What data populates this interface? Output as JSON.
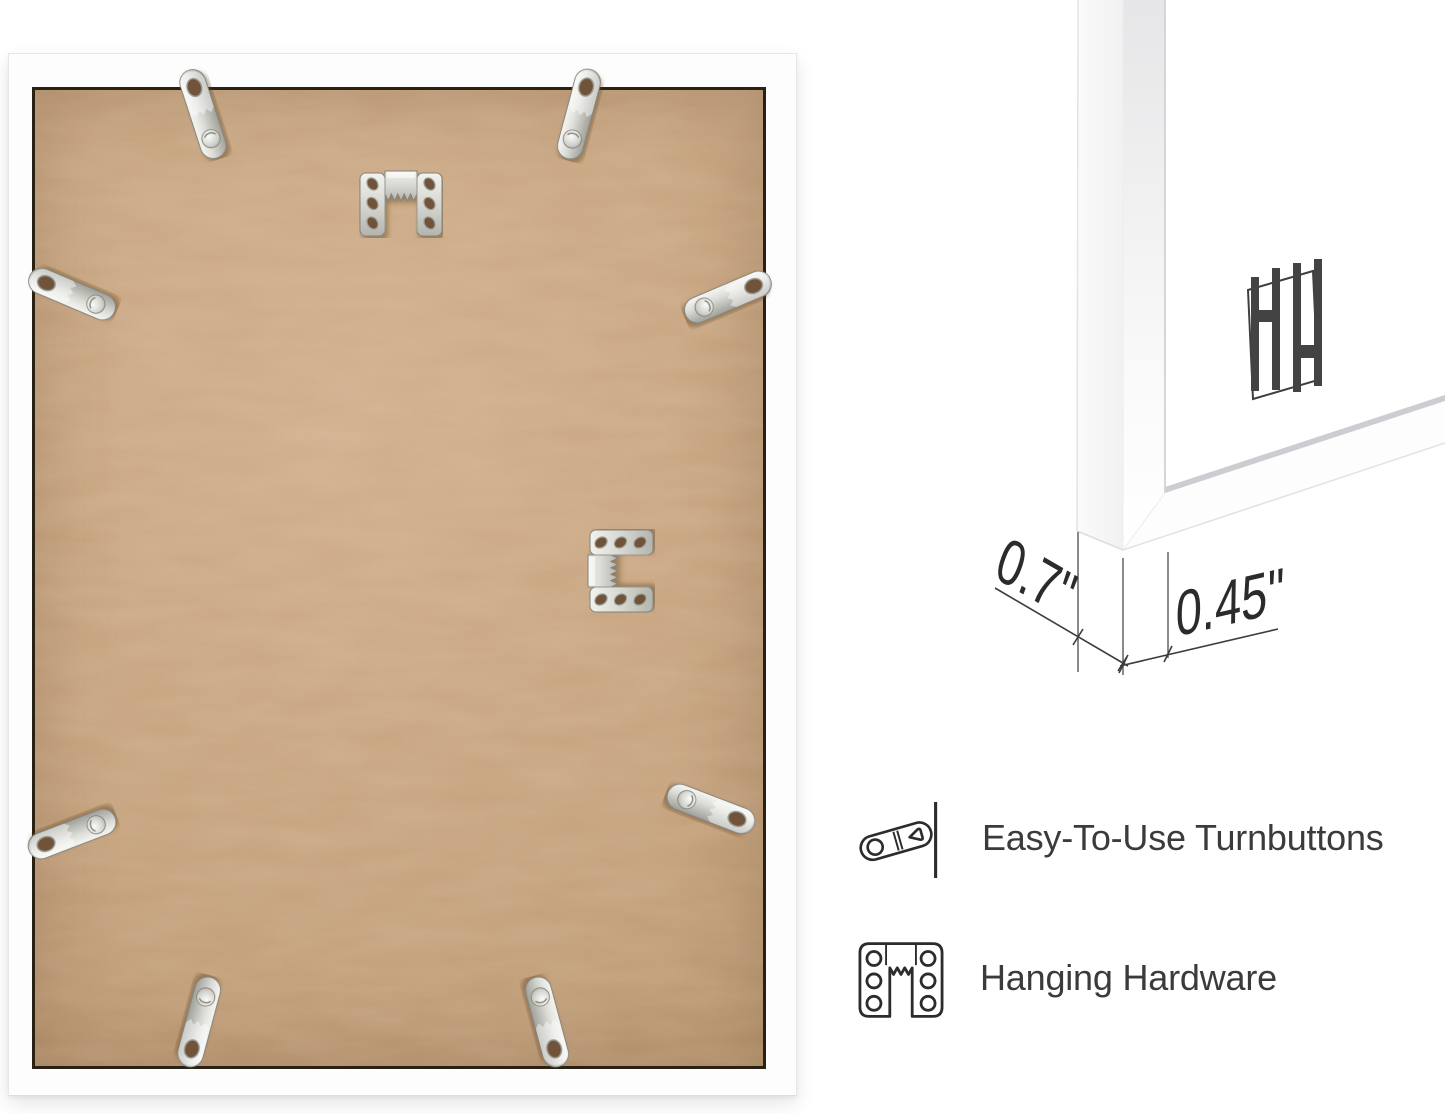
{
  "product": {
    "type": "picture-frame-back-infographic",
    "brand_logo_letters": "HH",
    "dimensions": {
      "depth": "0.7\"",
      "face_width": "0.45\""
    },
    "features": [
      {
        "icon": "turnbutton-icon",
        "label": "Easy-To-Use Turnbuttons"
      },
      {
        "icon": "hanging-hardware-icon",
        "label": "Hanging Hardware"
      }
    ],
    "hardware": {
      "turnbutton_count": 8,
      "sawtooth_hanger_count": 2
    },
    "colors": {
      "mdf_board": "#c8a37e",
      "frame": "#ffffff",
      "metal": "#d8d8d3",
      "ink": "#3b3b3b",
      "backing_edge_line": "#2a2115"
    }
  }
}
